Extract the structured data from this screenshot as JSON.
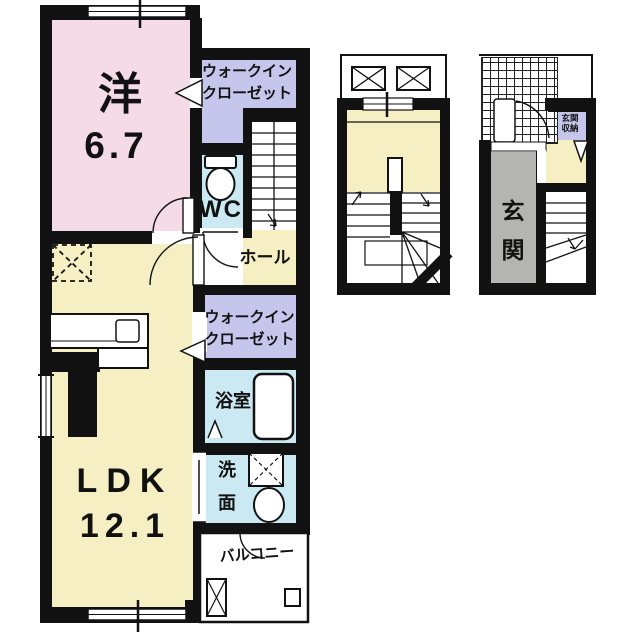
{
  "title": "apartment-floorplan",
  "colors": {
    "paper": "#ffffff",
    "wall": "#121212",
    "pink": "#f5dbe6",
    "yellow": "#f6efc3",
    "purple": "#c6c5eb",
    "blue": "#cbe9f2",
    "gray": "#b4b4b3",
    "line": "#1a1a1a"
  },
  "main_plan": {
    "western_room": {
      "name": "洋",
      "area": "6.7"
    },
    "walkin_closet_upper": {
      "line1": "ウォークイン",
      "line2": "クローゼット"
    },
    "toilet_label": "WC",
    "hall_label": "ホール",
    "walkin_closet_middle": {
      "line1": "ウォークイン",
      "line2": "クローゼット"
    },
    "bathroom_label": "浴室",
    "washroom": {
      "char1": "洗",
      "char2": "面"
    },
    "ldk": {
      "name": "LDK",
      "area": "12.1"
    },
    "balcony_label": "バルコニー"
  },
  "entrance_plan": {
    "entrance": {
      "char1": "玄",
      "char2": "関"
    },
    "storage": {
      "line1": "玄関",
      "line2": "収納"
    }
  }
}
